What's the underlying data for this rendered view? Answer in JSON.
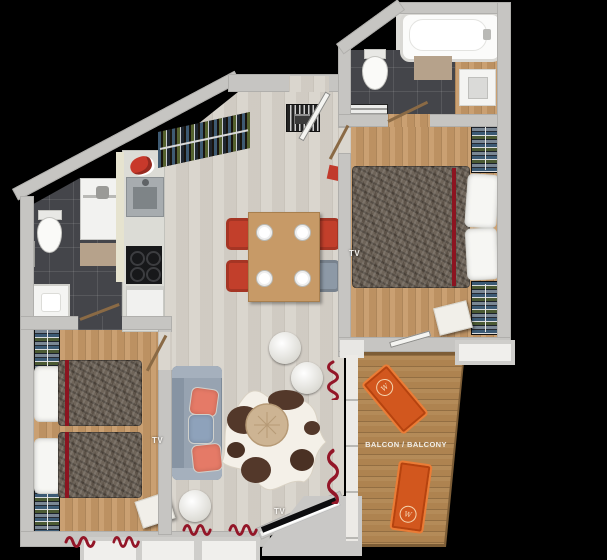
{
  "labels": {
    "balcony": "BALCON / BALCONY",
    "tv": "TV",
    "lounger_logo": "W"
  },
  "colors": {
    "background": "#000000",
    "wall": "#c6c5c2",
    "living_floor": "#d8d3cb",
    "bedroom_floor": "#c49868",
    "bathroom_tile": "#44454a",
    "balcony_deck": "#ae8350",
    "accent_red": "#c23f2b",
    "curtain_red": "#931628",
    "sofa_gray": "#97a3b1",
    "lounger_orange": "#d2571e"
  }
}
